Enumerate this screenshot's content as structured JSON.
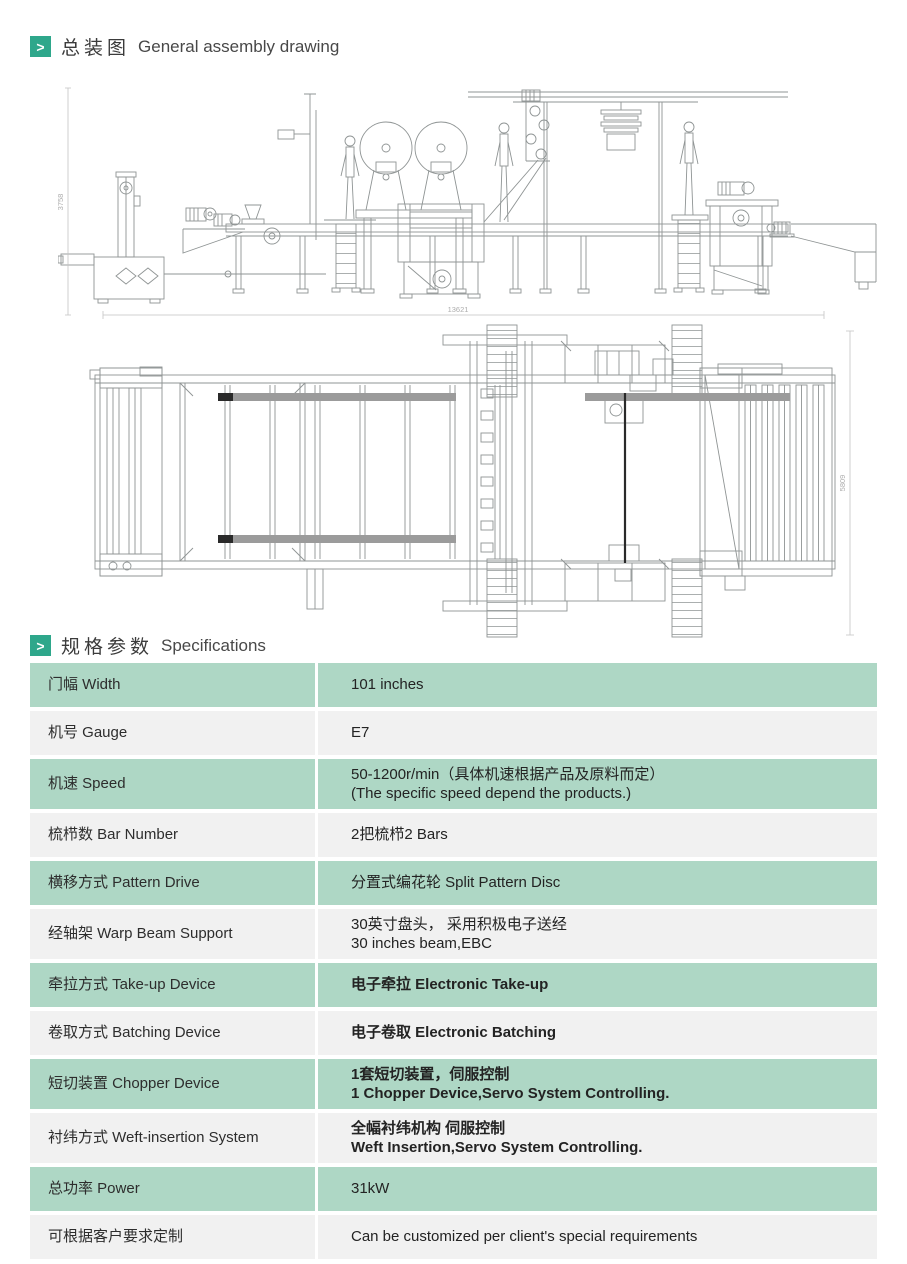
{
  "colors": {
    "accent": "#2ea78b",
    "row_green": "#aed7c5",
    "row_gray": "#f1f1f1",
    "drawing_line": "#8f9494",
    "dim_text": "#adadad"
  },
  "icons": {
    "chevron": ">"
  },
  "sections": {
    "assembly": {
      "title_zh": "总装图",
      "title_en": "General assembly drawing"
    },
    "specs": {
      "title_zh": "规格参数",
      "title_en": "Specifications"
    }
  },
  "drawings": {
    "side_view": {
      "height_dim": "3758",
      "length_dim": "13621"
    },
    "plan_view": {
      "width_dim": "5809"
    }
  },
  "specs_table": {
    "rows": [
      {
        "label": "门幅 Width",
        "value": "101 inches"
      },
      {
        "label": "机号 Gauge",
        "value": "E7"
      },
      {
        "label": "机速 Speed",
        "value": [
          "50-1200r/min（具体机速根据产品及原料而定）",
          "(The specific speed depend the products.)"
        ]
      },
      {
        "label": "梳栉数 Bar Number",
        "value": "2把梳栉2 Bars"
      },
      {
        "label": "横移方式 Pattern Drive",
        "value": "分置式编花轮 Split Pattern Disc"
      },
      {
        "label": "经轴架 Warp Beam Support",
        "value": [
          "30英寸盘头， 采用积极电子送经",
          "30 inches beam,EBC"
        ]
      },
      {
        "label": "牵拉方式 Take-up Device",
        "value": "电子牵拉 Electronic Take-up",
        "bold": true
      },
      {
        "label": "卷取方式 Batching Device",
        "value": "电子卷取 Electronic Batching",
        "bold": true
      },
      {
        "label": "短切装置 Chopper Device",
        "value": [
          "1套短切装置，伺服控制",
          "1 Chopper Device,Servo System Controlling."
        ],
        "bold": true
      },
      {
        "label": "衬纬方式 Weft-insertion System",
        "value": [
          "全幅衬纬机构 伺服控制",
          "Weft Insertion,Servo System Controlling."
        ],
        "bold": true
      },
      {
        "label": "总功率 Power",
        "value": "31kW"
      },
      {
        "label": "可根据客户要求定制",
        "value": "Can be customized per client's special requirements"
      }
    ]
  }
}
